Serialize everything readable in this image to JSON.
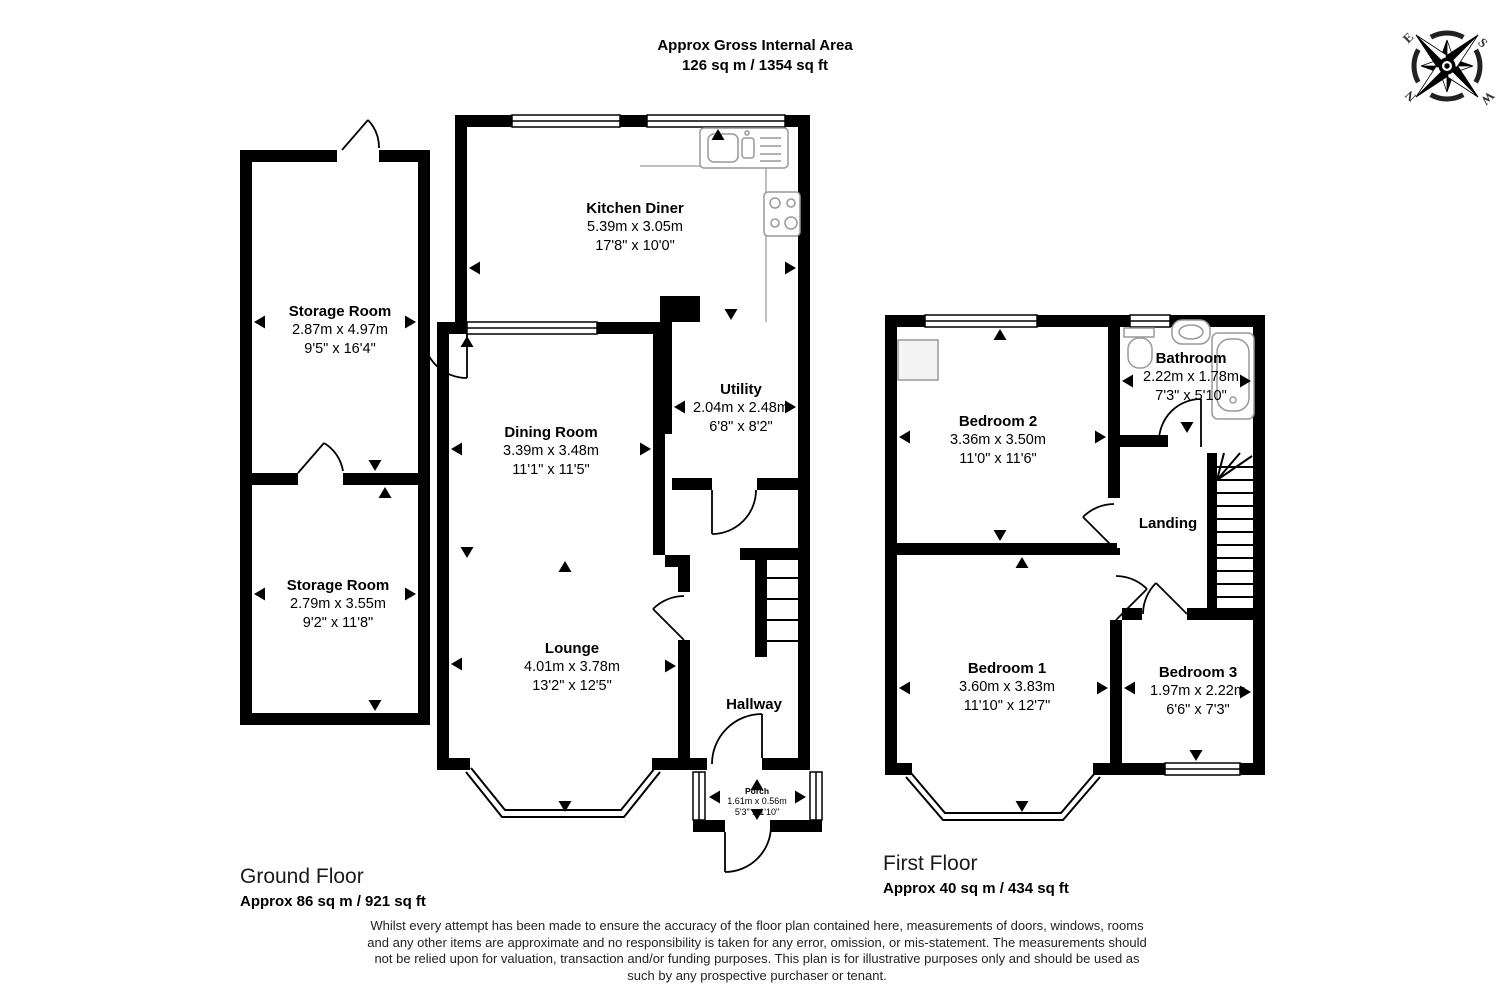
{
  "title": {
    "line1": "Approx Gross Internal Area",
    "line2": "126 sq m / 1354 sq ft"
  },
  "compass": {
    "n": "N",
    "e": "E",
    "s": "S",
    "w": "W"
  },
  "floors": {
    "ground": {
      "name": "Ground Floor",
      "area": "Approx 86 sq m / 921 sq ft"
    },
    "first": {
      "name": "First Floor",
      "area": "Approx 40 sq m / 434 sq ft"
    }
  },
  "rooms": {
    "kitchen_diner": {
      "name": "Kitchen Diner",
      "metric": "5.39m x 3.05m",
      "imperial": "17'8\" x 10'0\""
    },
    "storage_room_1": {
      "name": "Storage Room",
      "metric": "2.87m x 4.97m",
      "imperial": "9'5\" x 16'4\""
    },
    "storage_room_2": {
      "name": "Storage Room",
      "metric": "2.79m x 3.55m",
      "imperial": "9'2\" x 11'8\""
    },
    "dining_room": {
      "name": "Dining Room",
      "metric": "3.39m x 3.48m",
      "imperial": "11'1\" x 11'5\""
    },
    "utility": {
      "name": "Utility",
      "metric": "2.04m x 2.48m",
      "imperial": "6'8\" x 8'2\""
    },
    "lounge": {
      "name": "Lounge",
      "metric": "4.01m x 3.78m",
      "imperial": "13'2\" x 12'5\""
    },
    "hallway": {
      "name": "Hallway"
    },
    "porch": {
      "name": "Porch",
      "metric": "1.61m x 0.56m",
      "imperial": "5'3\" x 1'10\""
    },
    "bedroom_1": {
      "name": "Bedroom 1",
      "metric": "3.60m x 3.83m",
      "imperial": "11'10\" x 12'7\""
    },
    "bedroom_2": {
      "name": "Bedroom 2",
      "metric": "3.36m x 3.50m",
      "imperial": "11'0\" x 11'6\""
    },
    "bedroom_3": {
      "name": "Bedroom 3",
      "metric": "1.97m x 2.22m",
      "imperial": "6'6\" x 7'3\""
    },
    "bathroom": {
      "name": "Bathroom",
      "metric": "2.22m x 1.78m",
      "imperial": "7'3\" x 5'10\""
    },
    "landing": {
      "name": "Landing"
    }
  },
  "disclaimer": "Whilst every attempt has been made to ensure the accuracy of the floor plan contained here, measurements of doors, windows, rooms and any other items are approximate and no responsibility is taken for any error, omission, or mis-statement. The measurements should not be relied upon for valuation, transaction and/or funding purposes. This plan is for illustrative purposes only and should be used as such by any prospective purchaser or tenant.",
  "colors": {
    "wall": "#000000",
    "background": "#ffffff",
    "fixture": "#999999"
  }
}
